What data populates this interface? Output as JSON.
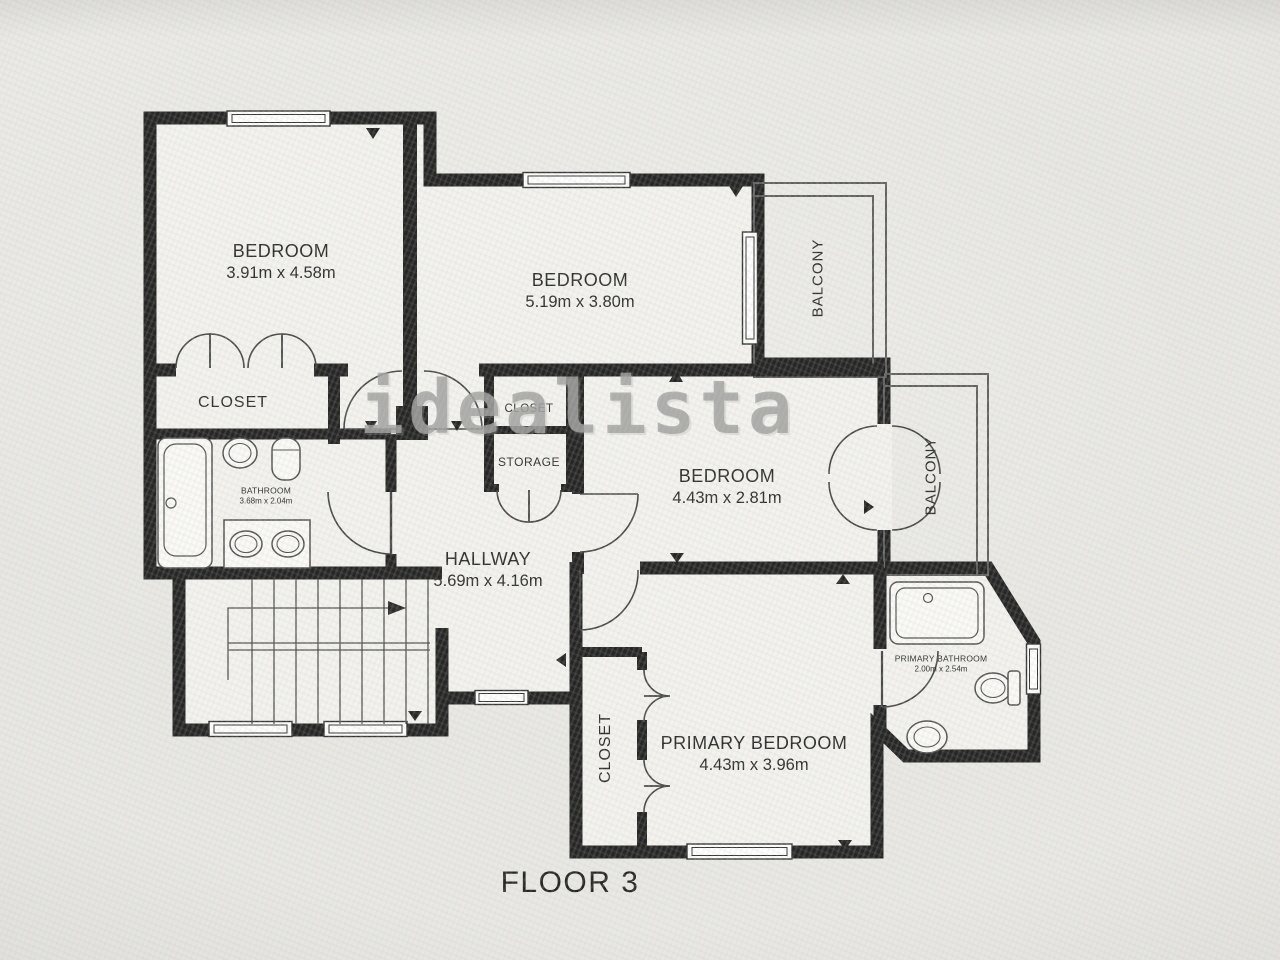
{
  "floor_title": "FLOOR 3",
  "watermark_text": "idealista",
  "colors": {
    "wall": "#1c1c1c",
    "room_fill": "#f4f3f0",
    "background": "#e9e8e5",
    "label_text": "#232323",
    "watermark": "#9e9e9c",
    "thin_line": "#5a5a5a"
  },
  "rooms": {
    "bedroom_top_left": {
      "name": "BEDROOM",
      "dimensions": "3.91m x 4.58m"
    },
    "bedroom_top_middle": {
      "name": "BEDROOM",
      "dimensions": "5.19m x 3.80m"
    },
    "bedroom_middle_right": {
      "name": "BEDROOM",
      "dimensions": "4.43m x 2.81m"
    },
    "primary_bedroom": {
      "name": "PRIMARY BEDROOM",
      "dimensions": "4.43m x 3.96m"
    },
    "hallway": {
      "name": "HALLWAY",
      "dimensions": "5.69m x 4.16m"
    },
    "bathroom": {
      "name": "BATHROOM",
      "dimensions": "3.68m x 2.04m"
    },
    "primary_bathroom": {
      "name": "PRIMARY BATHROOM",
      "dimensions": "2.00m x 2.54m"
    },
    "closet_top_left": {
      "name": "CLOSET"
    },
    "closet_center": {
      "name": "CLOSET"
    },
    "storage": {
      "name": "STORAGE"
    },
    "primary_closet": {
      "name": "CLOSET"
    },
    "balcony_top": {
      "name": "BALCONY"
    },
    "balcony_right": {
      "name": "BALCONY"
    }
  }
}
